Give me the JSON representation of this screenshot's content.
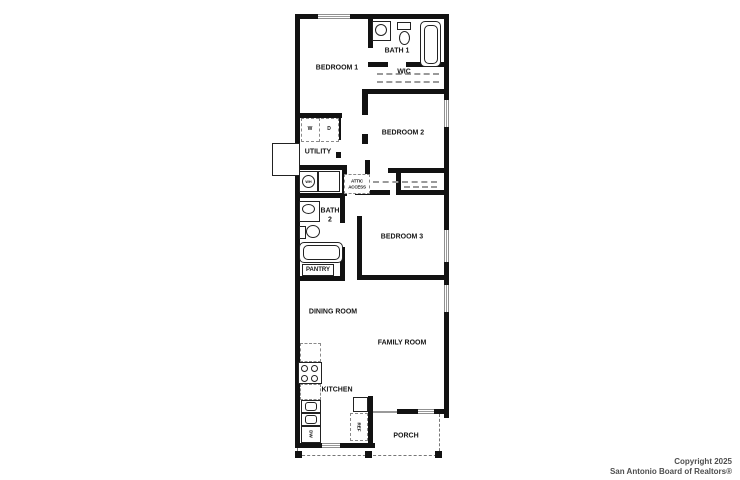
{
  "plan": {
    "rooms": {
      "bedroom1": "BEDROOM 1",
      "bath1": "BATH 1",
      "wic": "WIC",
      "bedroom2": "BEDROOM 2",
      "utility": "UTILITY",
      "bedroom3": "BEDROOM 3",
      "bath2": "BATH 2",
      "pantry": "PANTRY",
      "dining": "DINING ROOM",
      "family": "FAMILY ROOM",
      "kitchen": "KITCHEN",
      "porch": "PORCH"
    },
    "fixtures": {
      "washer": "W",
      "dryer": "D",
      "water_heater": "WH",
      "attic_access": "ATTIC ACCESS",
      "refrigerator": "REF",
      "dishwasher": "DW"
    },
    "colors": {
      "wall": "#121212",
      "window_gray": "#9a9a9a",
      "dash_gray": "#8a8a8a",
      "text": "#161616"
    }
  },
  "footer": {
    "line1": "Copyright 2025",
    "line2": "San Antonio Board of Realtors®"
  }
}
